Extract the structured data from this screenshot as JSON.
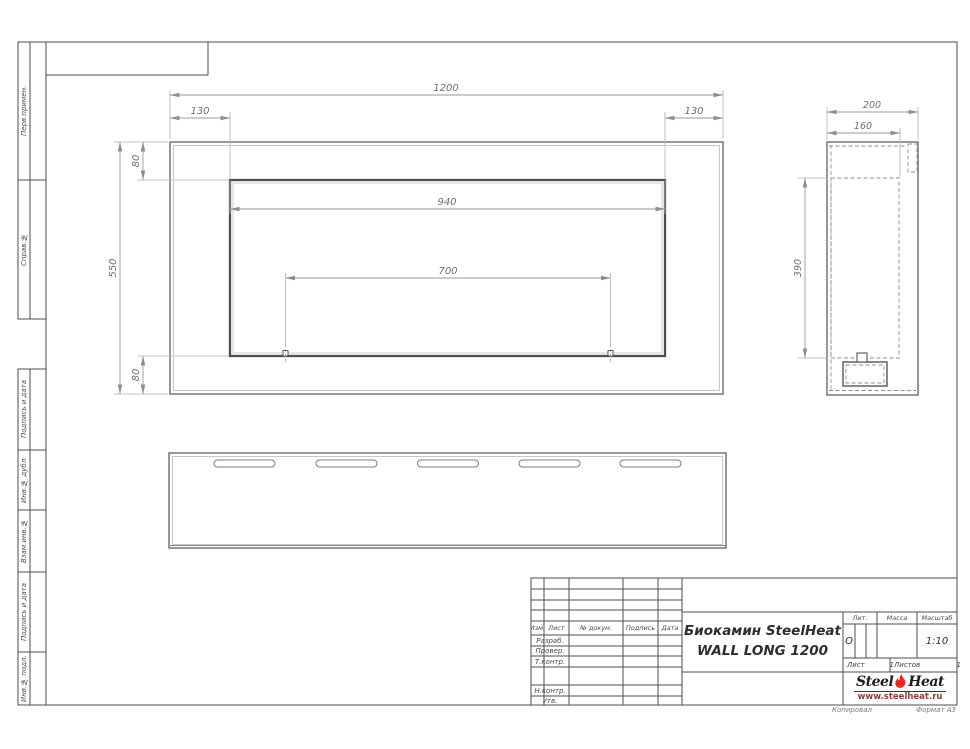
{
  "sheet": {
    "sidebar_cells": [
      "Перв.примен.",
      "Справ.№",
      "Подпись и дата",
      "Инв.№ дубл.",
      "Взам.инв.№",
      "Подпись и дата",
      "Инв.№ подл."
    ],
    "footer": {
      "copied_by": "Копировал",
      "format": "Формат А3"
    }
  },
  "dimensions": {
    "front": {
      "overall_width": "1200",
      "left_inset": "130",
      "right_inset": "130",
      "opening_width": "940",
      "mount_spacing": "700",
      "overall_height": "550",
      "top_offset": "80",
      "bottom_offset": "80"
    },
    "side": {
      "depth": "200",
      "inner_depth": "160",
      "opening_height": "390"
    }
  },
  "title_block": {
    "columns": {
      "izm": "Изм.",
      "sheet": "Лист",
      "doc": "№ докум.",
      "sign": "Подпись",
      "date": "Дата"
    },
    "roles": {
      "developed": "Разраб.",
      "checked": "Провер.",
      "tcontrol": "Т.контр.",
      "ncontrol": "Н.контр.",
      "approved": "Утв."
    },
    "title_line1": "Биокамин SteelHeat",
    "title_line2": "WALL LONG 1200",
    "lit_label": "Лит.",
    "lit_value": "О",
    "mass_label": "Масса",
    "scale_label": "Масштаб",
    "scale_value": "1:10",
    "sheet_label": "Лист",
    "sheet_value": "1",
    "sheets_label": "Листов",
    "sheets_value": "1",
    "logo": {
      "name_part1": "Steel",
      "name_part2": "Heat",
      "website": "www.steelheat.ru",
      "flame_color": "#e8251f"
    }
  }
}
